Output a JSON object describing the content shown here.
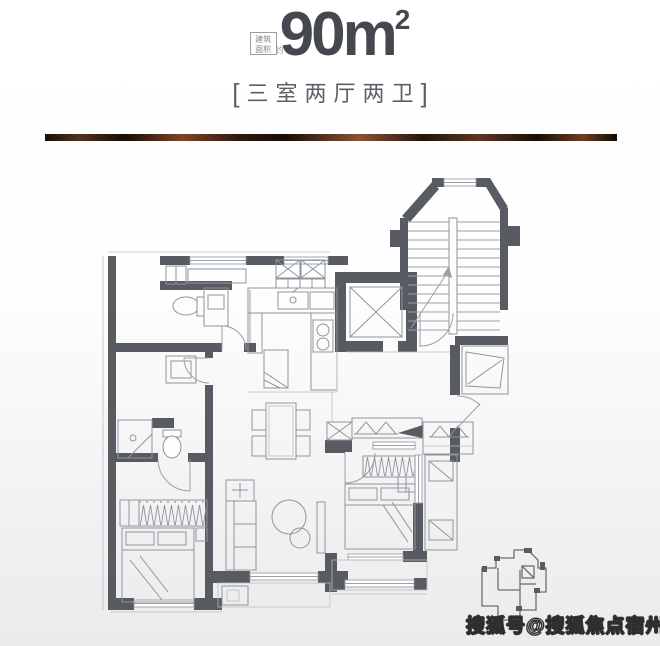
{
  "header": {
    "area_label": {
      "line1": "建筑",
      "line2": "面积",
      "suffix": "约"
    },
    "area_value": "90",
    "area_unit": "m",
    "area_exponent": "2",
    "bracket_open": "[",
    "layout_name": "三室两厅两卫",
    "bracket_close": "]",
    "text_color": "#45494f"
  },
  "divider_bar": {
    "style": "copper-gradient",
    "colors": [
      "#1b0f08",
      "#7c4527",
      "#170d07",
      "#8a5433",
      "#23140c",
      "#6e3d22"
    ]
  },
  "floor_plan": {
    "wall_color": "#585b61",
    "line_color": "#9aa0a7",
    "furniture_line_color": "#8f959c",
    "rooms": [
      "laundry",
      "bathroom-1",
      "kitchen",
      "elevator",
      "staircase",
      "foyer",
      "dining",
      "bathroom-2",
      "bedroom-left",
      "living-room",
      "master-bedroom",
      "balcony",
      "flower-bed",
      "ac-platform"
    ],
    "fixtures": [
      "washing-machines",
      "toilet",
      "vanity",
      "sink",
      "stove",
      "fridge",
      "shower",
      "dining-table",
      "chairs",
      "sofa",
      "coffee-table",
      "tv-cabinet",
      "beds",
      "wardrobes",
      "entry-door",
      "key-plan"
    ]
  },
  "watermark": {
    "text": "搜狐号@搜狐焦点宿州站",
    "fill": "#ffffff",
    "outline": "#2e2e2e"
  }
}
